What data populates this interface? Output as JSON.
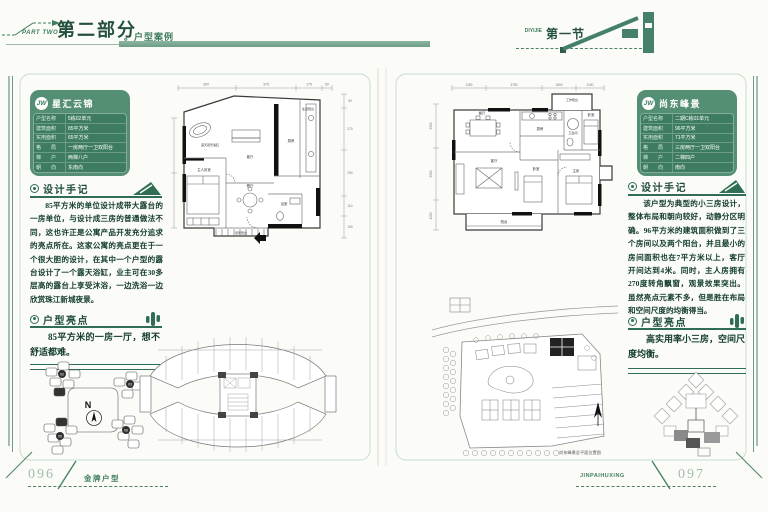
{
  "header": {
    "part_en": "PART TWO",
    "part_cn": "第二部分",
    "part_topic": "。户型案例",
    "section_en": "DIYIJIE",
    "section_cn": "第一节"
  },
  "footer": {
    "left_page_no": "096",
    "left_label": "金牌户型",
    "right_label": "JINPAIHUXING",
    "right_page_no": "097"
  },
  "left_page": {
    "card": {
      "logo": "JW",
      "title": "星汇云锦",
      "rows": [
        {
          "label": "户型名称",
          "value": "5栋02单元"
        },
        {
          "label": "建筑面积",
          "value": "85平方米"
        },
        {
          "label": "实用面积",
          "value": "65平方米"
        },
        {
          "label": "格　　局",
          "value": "一房两厅一卫双阳台"
        },
        {
          "label": "梯　　户",
          "value": "两梯八户"
        },
        {
          "label": "朝　　向",
          "value": "东南向"
        }
      ]
    },
    "notes": {
      "heading": "设计手记",
      "body": "85平方米的单位设计成带大露台的一房单位，与设计成三房的普通做法不同，这也许正是公寓产品开发充分追求的亮点所在。这家公寓的亮点更在于一个很大胆的设计，在其中一个户型的露台设计了一个露天浴缸，业主可在30多层高的露台上享受沐浴，一边洗浴一边欣赏珠江新城夜景。"
    },
    "highlight": {
      "heading": "户型亮点",
      "body": "85平方米的一房一厅，想不舒适都难。"
    },
    "unit_plan": {
      "rooms": {
        "bath_deck": "露天观景浴缸",
        "living": "客厅",
        "dining": "餐厅",
        "master": "主人卧室",
        "life_balcony": "生活阳台",
        "kitchen": "厨房",
        "bathroom": "浴室",
        "view_balcony": "观景阳台"
      },
      "dims_top": [
        "360",
        "375",
        "175",
        "50"
      ],
      "dims_right": [
        "90",
        "270",
        "290",
        "110",
        "150"
      ]
    },
    "key_plan": {
      "compass": "N",
      "units": [
        "02",
        "03",
        "05",
        "06"
      ]
    }
  },
  "right_page": {
    "card": {
      "logo": "JW",
      "title": "尚东峰景",
      "rows": [
        {
          "label": "户型名称",
          "value": "二期C栋01单元"
        },
        {
          "label": "建筑面积",
          "value": "96平方米"
        },
        {
          "label": "实用面积",
          "value": "71平方米"
        },
        {
          "label": "格　　局",
          "value": "三房两厅一卫双阳台"
        },
        {
          "label": "梯　　户",
          "value": "二梯四户"
        },
        {
          "label": "朝　　向",
          "value": "南向"
        }
      ]
    },
    "notes": {
      "heading": "设计手记",
      "body": "该户型为典型的小三房设计，整体布局和朝向较好，动静分区明确。96平方米的建筑面积做到了三个房间以及两个阳台，并且最小的房间面积也在7平方米以上，客厅开间达到4米。同时，主人房拥有270度转角飘窗，观景效果突出。虽然亮点元素不多，但是胜在布局和空间尺度的均衡得当。"
    },
    "highlight": {
      "heading": "户型亮点",
      "body": "高实用率小三房，空间尺度均衡。"
    },
    "unit_plan": {
      "rooms": {
        "dining": "餐厅",
        "kitchen": "厨房",
        "living": "客厅",
        "balcony": "阳台",
        "bedroom": "卧室",
        "bedroom2": "卧室",
        "master": "主卧",
        "bath": "卫生间",
        "work_balcony": "工作阳台"
      },
      "dims_top": [
        "1150",
        "3750",
        "1800",
        "1100"
      ],
      "dims_left": [
        "3300",
        "3900",
        "1200"
      ]
    },
    "site_plan": {
      "caption": "尚东峰景总平面位置图"
    }
  }
}
